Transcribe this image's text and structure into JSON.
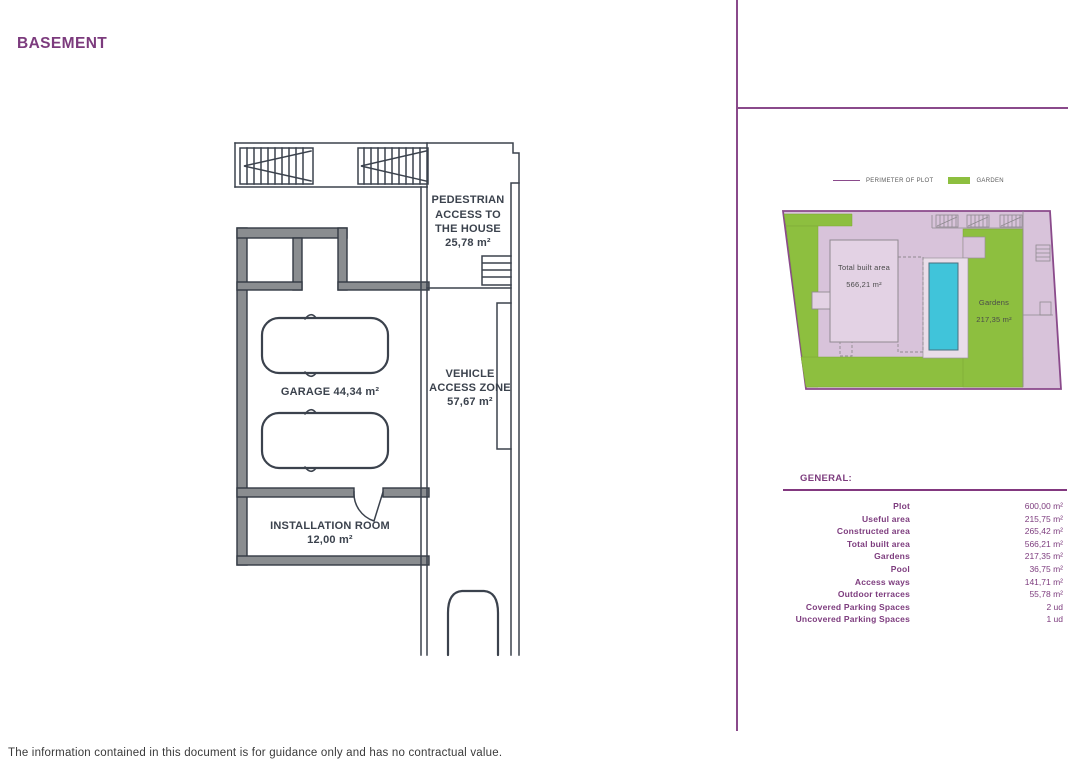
{
  "page": {
    "title": "BASEMENT",
    "disclaimer": "The information contained in this document is for guidance only and has no contractual value."
  },
  "legend": {
    "perimeter": "PERIMETER OF PLOT",
    "garden": "GARDEN"
  },
  "floor_plan": {
    "pedestrian_access": [
      "PEDESTRIAN",
      "ACCESS TO",
      "THE HOUSE",
      "25,78 m²"
    ],
    "garage_label": "GARAGE 44,34 m²",
    "vehicle_access": [
      "VEHICLE",
      "ACCESS ZONE",
      "57,67 m²"
    ],
    "installation_room": [
      "INSTALLATION ROOM",
      "12,00 m²"
    ]
  },
  "site_plan": {
    "total_built_area": [
      "Total built area",
      "566,21 m²"
    ],
    "gardens": [
      "Gardens",
      "217,35 m²"
    ]
  },
  "general": {
    "heading": "GENERAL:",
    "rows": [
      {
        "label": "Plot",
        "value": "600,00 m²"
      },
      {
        "label": "Useful area",
        "value": "215,75 m²"
      },
      {
        "label": "Constructed area",
        "value": "265,42 m²"
      },
      {
        "label": "Total built area",
        "value": "566,21 m²"
      },
      {
        "label": "Gardens",
        "value": "217,35 m²"
      },
      {
        "label": "Pool",
        "value": "36,75 m²"
      },
      {
        "label": "Access ways",
        "value": "141,71 m²"
      },
      {
        "label": "Outdoor terraces",
        "value": "55,78 m²"
      },
      {
        "label": "Covered Parking Spaces",
        "value": "2 ud"
      },
      {
        "label": "Uncovered Parking Spaces",
        "value": "1 ud"
      }
    ]
  },
  "colors": {
    "brand_purple": "#7d3c7e",
    "line_purple": "#8a4a8b",
    "garden_green": "#8dbf3f",
    "pool_cyan": "#40c4da",
    "plot_lavender": "#d8c3da",
    "plan_ink": "#3b424d"
  }
}
